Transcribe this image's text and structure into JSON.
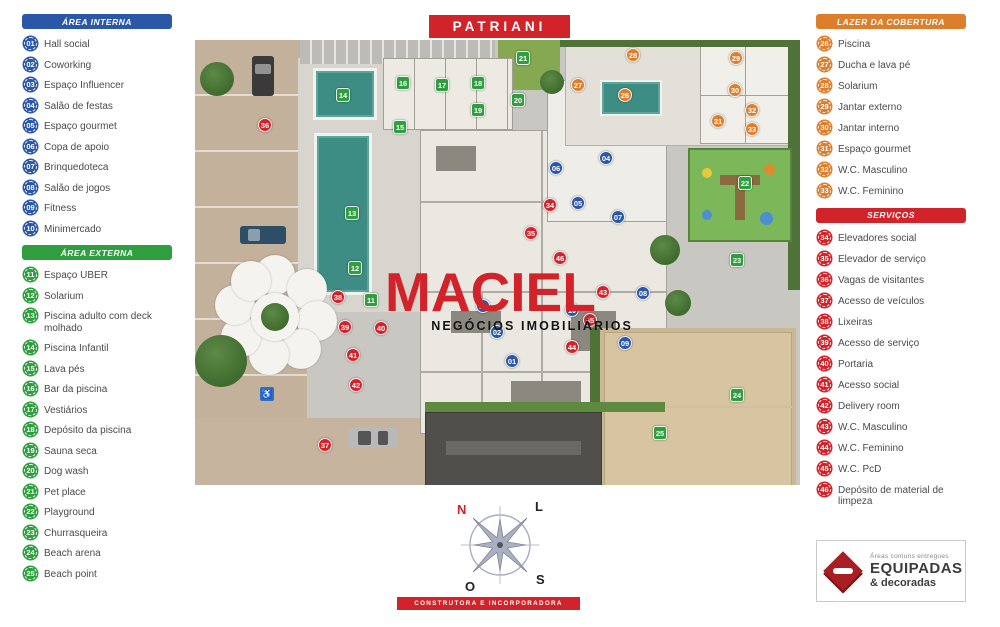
{
  "title": "PATRIANI",
  "footer": "CONSTRUTORA E INCORPORADORA",
  "watermark": {
    "name": "MACIEL",
    "subtitle": "NEGÓCIOS IMOBILIÁRIOS"
  },
  "compass": {
    "north": "N",
    "east": "L",
    "west": "O",
    "south": "S"
  },
  "colors": {
    "brand_red": "#d2232a",
    "area_interna_blue": "#2b57a8",
    "area_externa_green": "#2f9e3f",
    "lazer_orange": "#dd7e2c",
    "servicos_red": "#d2232a",
    "pool_teal": "#3e8d84"
  },
  "legends": {
    "area_interna": {
      "title": "ÁREA INTERNA",
      "color": "#2b57a8",
      "items": [
        {
          "num": "01",
          "label": "Hall social"
        },
        {
          "num": "02",
          "label": "Coworking"
        },
        {
          "num": "03",
          "label": "Espaço Influencer"
        },
        {
          "num": "04",
          "label": "Salão de festas"
        },
        {
          "num": "05",
          "label": "Espaço gourmet"
        },
        {
          "num": "06",
          "label": "Copa de apoio"
        },
        {
          "num": "07",
          "label": "Brinquedoteca"
        },
        {
          "num": "08",
          "label": "Salão de jogos"
        },
        {
          "num": "09",
          "label": "Fitness"
        },
        {
          "num": "10",
          "label": "Minimercado"
        }
      ]
    },
    "area_externa": {
      "title": "ÁREA EXTERNA",
      "color": "#2f9e3f",
      "items": [
        {
          "num": "11",
          "label": "Espaço UBER"
        },
        {
          "num": "12",
          "label": "Solarium"
        },
        {
          "num": "13",
          "label": "Piscina adulto com deck molhado"
        },
        {
          "num": "14",
          "label": "Piscina Infantil"
        },
        {
          "num": "15",
          "label": "Lava pés"
        },
        {
          "num": "16",
          "label": "Bar da piscina"
        },
        {
          "num": "17",
          "label": "Vestiários"
        },
        {
          "num": "18",
          "label": "Depósito da piscina"
        },
        {
          "num": "19",
          "label": "Sauna seca"
        },
        {
          "num": "20",
          "label": "Dog wash"
        },
        {
          "num": "21",
          "label": "Pet place"
        },
        {
          "num": "22",
          "label": "Playground"
        },
        {
          "num": "23",
          "label": "Churrasqueira"
        },
        {
          "num": "24",
          "label": "Beach arena"
        },
        {
          "num": "25",
          "label": "Beach point"
        }
      ]
    },
    "lazer_cobertura": {
      "title": "LAZER DA COBERTURA",
      "color": "#dd7e2c",
      "items": [
        {
          "num": "26",
          "label": "Piscina"
        },
        {
          "num": "27",
          "label": "Ducha e lava pé"
        },
        {
          "num": "28",
          "label": "Solarium"
        },
        {
          "num": "29",
          "label": "Jantar externo"
        },
        {
          "num": "30",
          "label": "Jantar interno"
        },
        {
          "num": "31",
          "label": "Espaço gourmet"
        },
        {
          "num": "32",
          "label": "W.C. Masculino"
        },
        {
          "num": "33",
          "label": "W.C. Feminino"
        }
      ]
    },
    "servicos": {
      "title": "SERVIÇOS",
      "color": "#d2232a",
      "items": [
        {
          "num": "34",
          "label": "Elevadores social"
        },
        {
          "num": "35",
          "label": "Elevador de serviço"
        },
        {
          "num": "36",
          "label": "Vagas de visitantes"
        },
        {
          "num": "37",
          "label": "Acesso de veículos"
        },
        {
          "num": "38",
          "label": "Lixeiras"
        },
        {
          "num": "39",
          "label": "Acesso de serviço"
        },
        {
          "num": "40",
          "label": "Portaria"
        },
        {
          "num": "41",
          "label": "Acesso social"
        },
        {
          "num": "42",
          "label": "Delivery room"
        },
        {
          "num": "43",
          "label": "W.C. Masculino"
        },
        {
          "num": "44",
          "label": "W.C. Feminino"
        },
        {
          "num": "45",
          "label": "W.C. PcD"
        },
        {
          "num": "46",
          "label": "Depósito de material de limpeza"
        }
      ]
    }
  },
  "badge": {
    "top_line": "Áreas comuns entregues",
    "main_line": "EQUIPADAS",
    "sub_line": "& decoradas"
  },
  "map_markers": [
    {
      "num": "01",
      "group": "interna",
      "x": 512,
      "y": 361
    },
    {
      "num": "02",
      "group": "interna",
      "x": 497,
      "y": 332
    },
    {
      "num": "03",
      "group": "interna",
      "x": 483,
      "y": 306
    },
    {
      "num": "04",
      "group": "interna",
      "x": 606,
      "y": 158
    },
    {
      "num": "05",
      "group": "interna",
      "x": 578,
      "y": 203
    },
    {
      "num": "06",
      "group": "interna",
      "x": 556,
      "y": 168
    },
    {
      "num": "07",
      "group": "interna",
      "x": 618,
      "y": 217
    },
    {
      "num": "08",
      "group": "interna",
      "x": 643,
      "y": 293
    },
    {
      "num": "09",
      "group": "interna",
      "x": 625,
      "y": 343
    },
    {
      "num": "10",
      "group": "interna",
      "x": 572,
      "y": 310
    },
    {
      "num": "11",
      "group": "externa",
      "x": 371,
      "y": 300
    },
    {
      "num": "12",
      "group": "externa",
      "x": 355,
      "y": 268
    },
    {
      "num": "13",
      "group": "externa",
      "x": 352,
      "y": 213
    },
    {
      "num": "14",
      "group": "externa",
      "x": 343,
      "y": 95
    },
    {
      "num": "15",
      "group": "externa",
      "x": 400,
      "y": 127
    },
    {
      "num": "16",
      "group": "externa",
      "x": 403,
      "y": 83
    },
    {
      "num": "17",
      "group": "externa",
      "x": 442,
      "y": 85
    },
    {
      "num": "18",
      "group": "externa",
      "x": 478,
      "y": 83
    },
    {
      "num": "19",
      "group": "externa",
      "x": 478,
      "y": 110
    },
    {
      "num": "20",
      "group": "externa",
      "x": 518,
      "y": 100
    },
    {
      "num": "21",
      "group": "externa",
      "x": 523,
      "y": 58
    },
    {
      "num": "22",
      "group": "externa",
      "x": 745,
      "y": 183
    },
    {
      "num": "23",
      "group": "externa",
      "x": 737,
      "y": 260
    },
    {
      "num": "24",
      "group": "externa",
      "x": 737,
      "y": 395
    },
    {
      "num": "25",
      "group": "externa",
      "x": 660,
      "y": 433
    },
    {
      "num": "26",
      "group": "cobertura",
      "x": 625,
      "y": 95
    },
    {
      "num": "27",
      "group": "cobertura",
      "x": 578,
      "y": 85
    },
    {
      "num": "28",
      "group": "cobertura",
      "x": 633,
      "y": 55
    },
    {
      "num": "29",
      "group": "cobertura",
      "x": 736,
      "y": 58
    },
    {
      "num": "30",
      "group": "cobertura",
      "x": 735,
      "y": 90
    },
    {
      "num": "31",
      "group": "cobertura",
      "x": 718,
      "y": 121
    },
    {
      "num": "32",
      "group": "cobertura",
      "x": 752,
      "y": 110
    },
    {
      "num": "33",
      "group": "cobertura",
      "x": 752,
      "y": 129
    },
    {
      "num": "34",
      "group": "servicos",
      "x": 550,
      "y": 205
    },
    {
      "num": "35",
      "group": "servicos",
      "x": 531,
      "y": 233
    },
    {
      "num": "36",
      "group": "servicos",
      "x": 265,
      "y": 125
    },
    {
      "num": "37",
      "group": "servicos",
      "x": 325,
      "y": 445
    },
    {
      "num": "38",
      "group": "servicos",
      "x": 338,
      "y": 297
    },
    {
      "num": "39",
      "group": "servicos",
      "x": 345,
      "y": 327
    },
    {
      "num": "40",
      "group": "servicos",
      "x": 381,
      "y": 328
    },
    {
      "num": "41",
      "group": "servicos",
      "x": 353,
      "y": 355
    },
    {
      "num": "42",
      "group": "servicos",
      "x": 356,
      "y": 385
    },
    {
      "num": "43",
      "group": "servicos",
      "x": 603,
      "y": 292
    },
    {
      "num": "44",
      "group": "servicos",
      "x": 572,
      "y": 347
    },
    {
      "num": "45",
      "group": "servicos",
      "x": 590,
      "y": 320
    },
    {
      "num": "46",
      "group": "servicos",
      "x": 560,
      "y": 258
    }
  ]
}
